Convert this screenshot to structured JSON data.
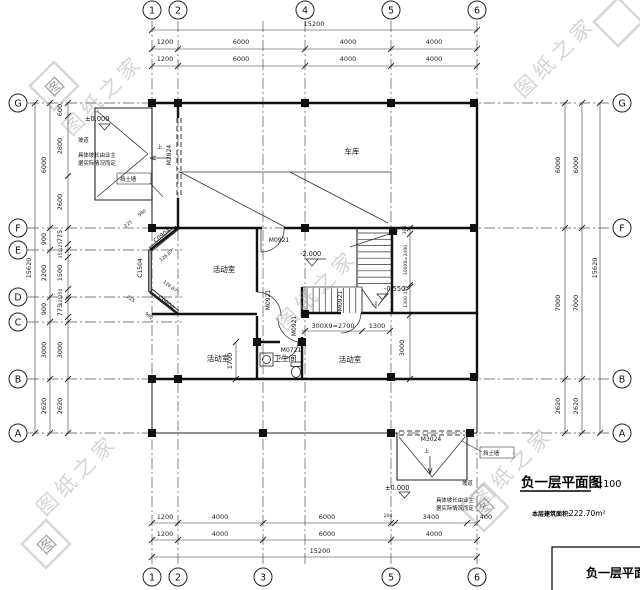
{
  "watermark": {
    "text": "图纸之家",
    "seal": "图"
  },
  "axes": {
    "top": [
      "1",
      "2",
      "4",
      "5",
      "6"
    ],
    "bottom": [
      "1",
      "2",
      "3",
      "5",
      "6"
    ],
    "left": [
      "G",
      "F",
      "E",
      "D",
      "C",
      "B",
      "A"
    ],
    "right": [
      "G",
      "F",
      "B",
      "A"
    ]
  },
  "dims": {
    "top_total": "15200",
    "top_row1": [
      "1200",
      "6000",
      "4000",
      "4000"
    ],
    "top_row2": [
      "1200",
      "6000",
      "4000",
      "4000"
    ],
    "bottom_row1": [
      "1200",
      "4000",
      "6000",
      "200",
      "3400",
      "400"
    ],
    "bottom_row2": [
      "1200",
      "4000",
      "6000",
      "4000"
    ],
    "bottom_total": "15200",
    "left_total": "15620",
    "left_mid": [
      "6000",
      "900",
      "2200",
      "900",
      "3000",
      "2620"
    ],
    "left_inner": [
      "600",
      "2800",
      "2600",
      "775",
      "125",
      "350",
      "1500",
      "350",
      "125",
      "775",
      "3000",
      "2620"
    ],
    "right_inner": [
      "6000",
      "7000",
      "2620"
    ],
    "right_outer": [
      "6000",
      "7000",
      "2620"
    ],
    "right_total": "15620",
    "stair_h": "300X9=2700",
    "stair_h2": "1300",
    "stair_v0": "300",
    "stair_v": "300X8=2400",
    "stair_v2": "100",
    "stair_v3": "1300",
    "stair_v4": "3000",
    "bath_depth": "1700",
    "bay_top_a": "980",
    "bay_top_b": "225",
    "bay_bot_a": "225",
    "bay_bot_b": "980",
    "bay_angle": "126.87°"
  },
  "rooms": {
    "garage": "车库",
    "activity": "活动室",
    "bath": "卫生间"
  },
  "openings": {
    "m2824": "M2824",
    "m0921": "M0921",
    "m0721": "M0721",
    "m3024": "M3024",
    "c1504": "C1504",
    "c0904": "C0904"
  },
  "levels": {
    "zero": "±0.000",
    "neg2": "-2.000",
    "neg055": "-0.550"
  },
  "notes": {
    "ramp": "坡道",
    "retaining": "挡土墙",
    "up": "上",
    "line1": "具体坡长由业主",
    "line2": "据实际情况而定"
  },
  "title": {
    "name": "负一层平面图",
    "scale": "1:100",
    "area_label": "本层建筑面积:",
    "area_value": "222.70m²",
    "block": "负一层平面图"
  }
}
